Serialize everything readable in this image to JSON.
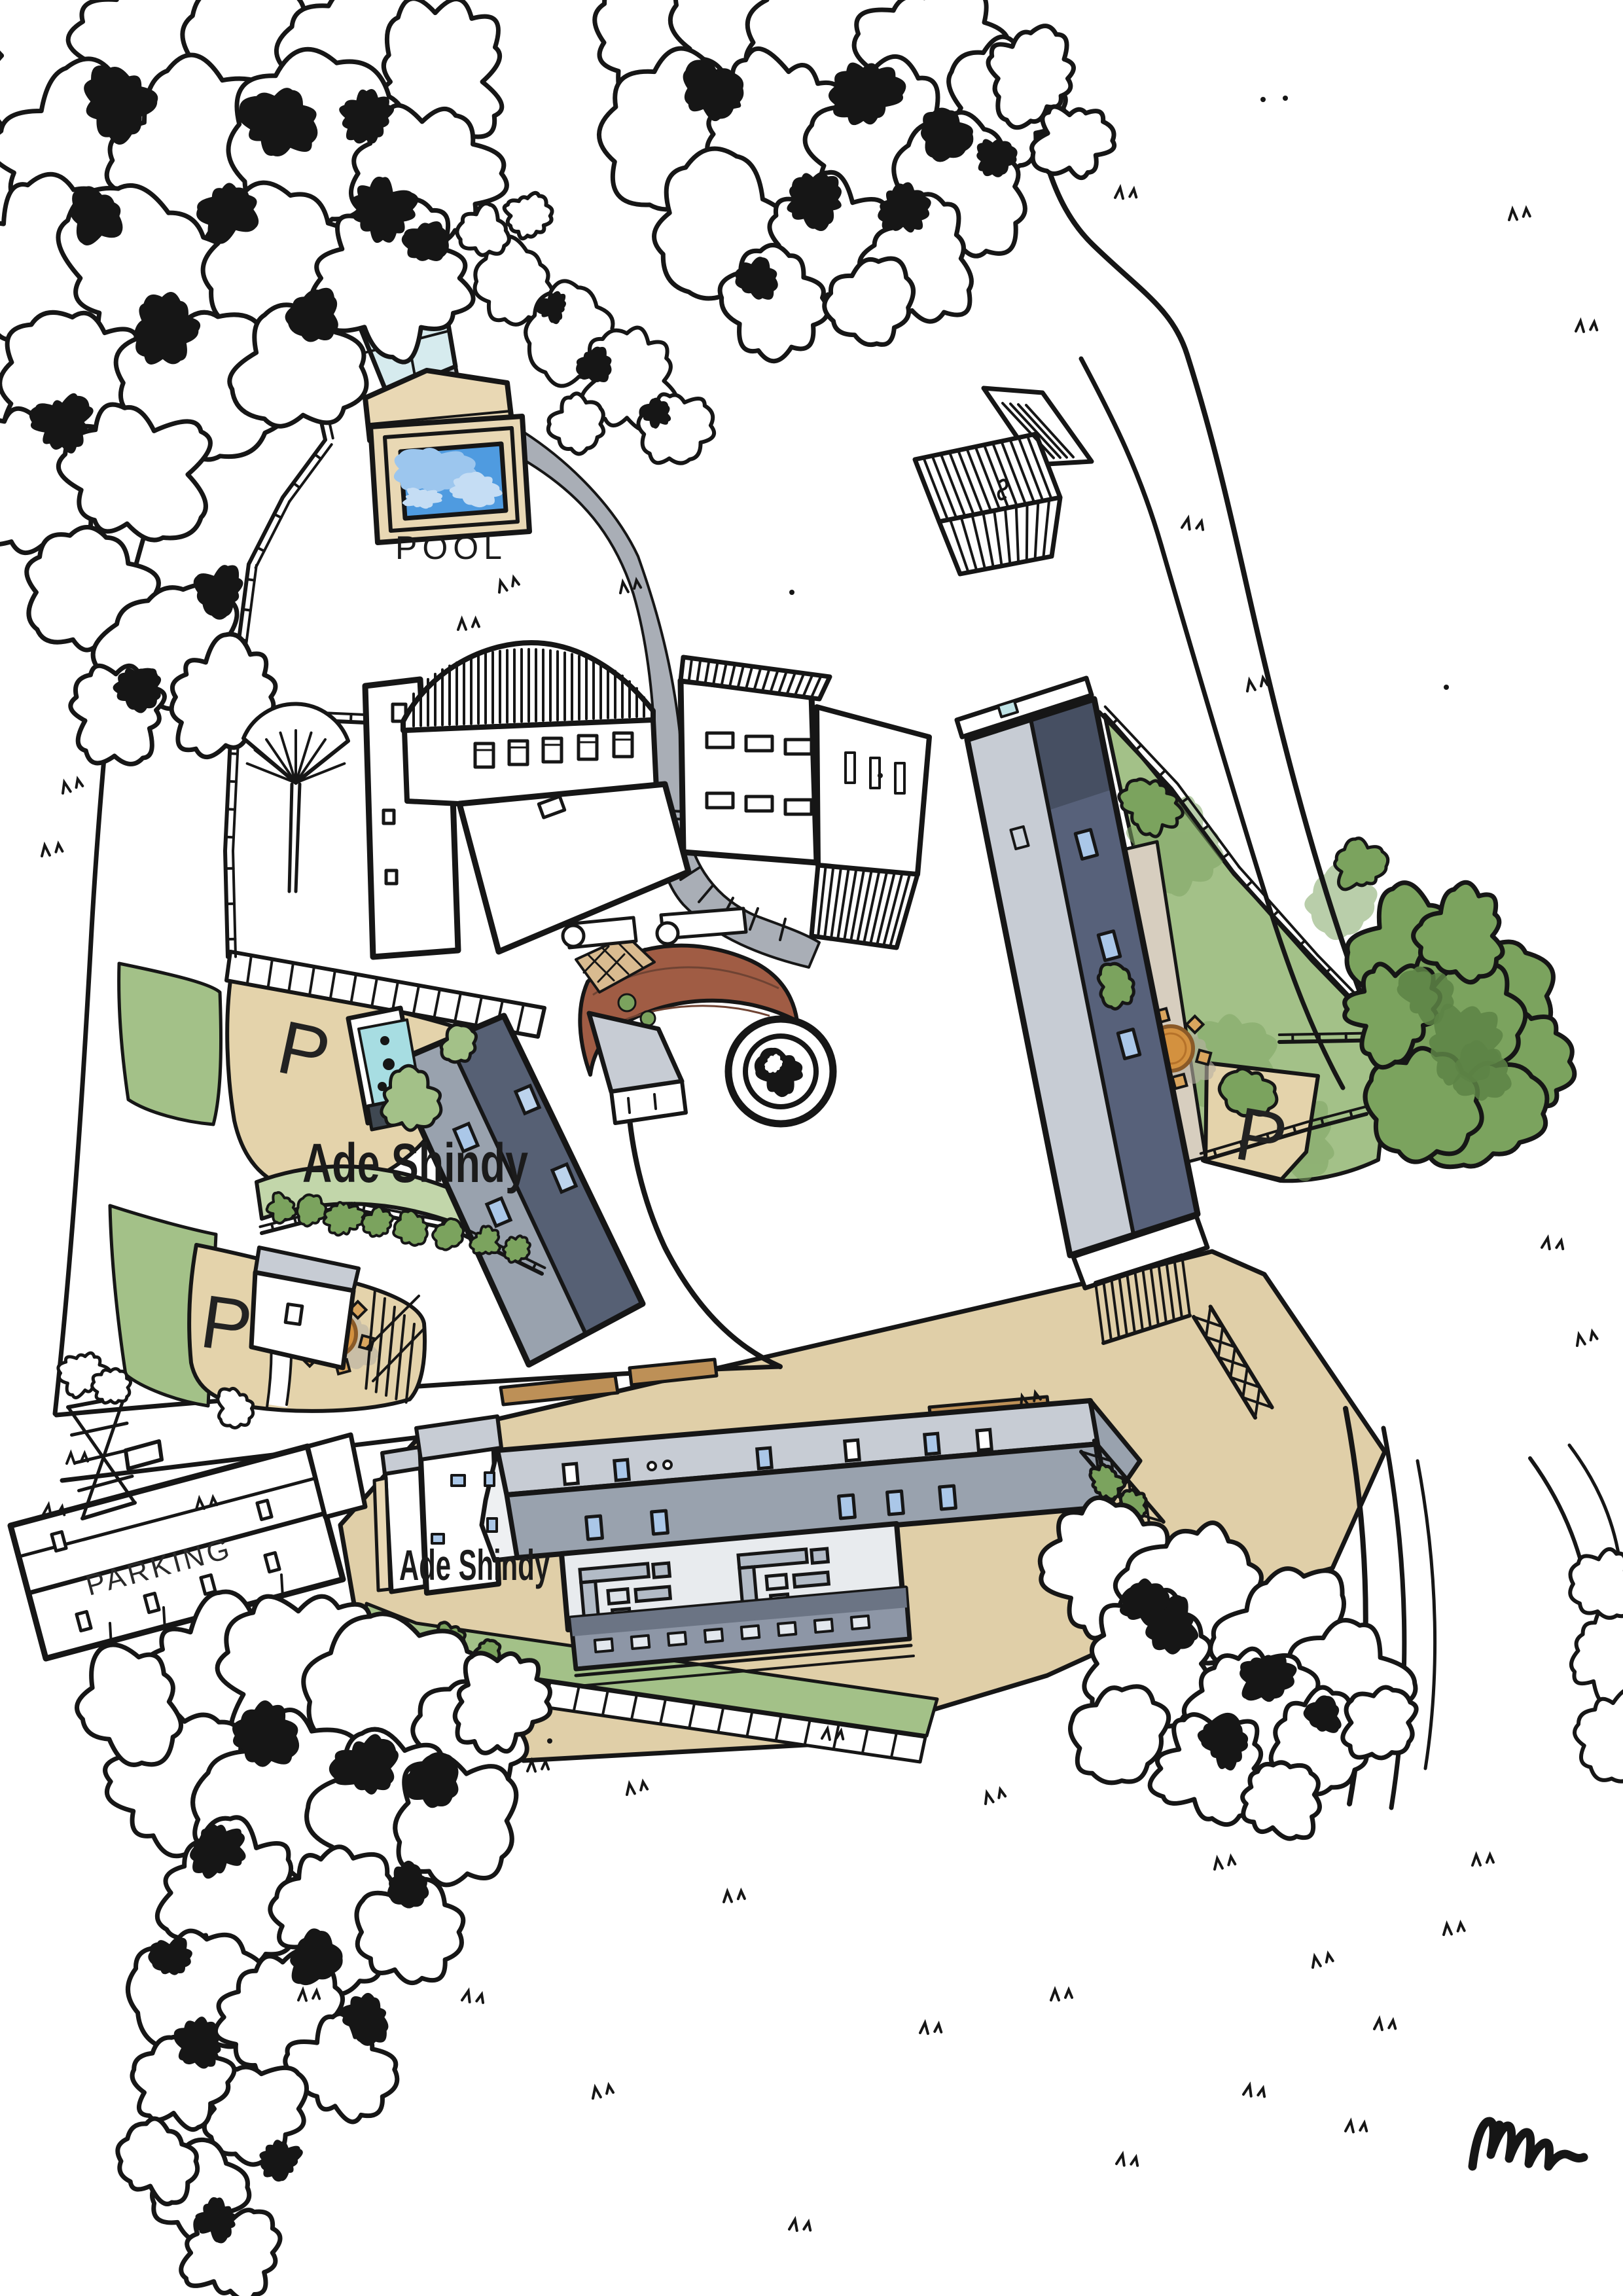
{
  "map": {
    "labels": {
      "pool": "POOL",
      "parking_building": "PARKING",
      "estate_upper": "Ade Shindy",
      "estate_lower": "Ade Shindy",
      "parking_spot_left_upper": "P",
      "parking_spot_left_lower": "P",
      "parking_spot_right": "P"
    }
  },
  "palette": {
    "ink": "#161616",
    "paper": "#ffffff",
    "pool_water": "#4f9be0",
    "pool_water_light": "#9cc6ee",
    "deck_tan": "#e9d8b4",
    "parking_tan": "#e4d3ab",
    "ground_tan": "#e0cfa8",
    "grass": "#a3c188",
    "grass_dark": "#7fa564",
    "tree_green": "#7ba35e",
    "tree_green_dark": "#5d8445",
    "roof_light": "#c7ccd4",
    "roof_mid": "#99a2ae",
    "roof_dark": "#57617a",
    "path_gray": "#a9aeb6",
    "glass_blue": "#d6ebee",
    "teal": "#a7dde2",
    "brick": "#a05c44",
    "tile_tan": "#d9bb90",
    "terrace_gray": "#e8ebee",
    "deck_slate": "#8d96a6",
    "table_orange": "#d3913f",
    "skylight_blue": "#aac7e8"
  }
}
